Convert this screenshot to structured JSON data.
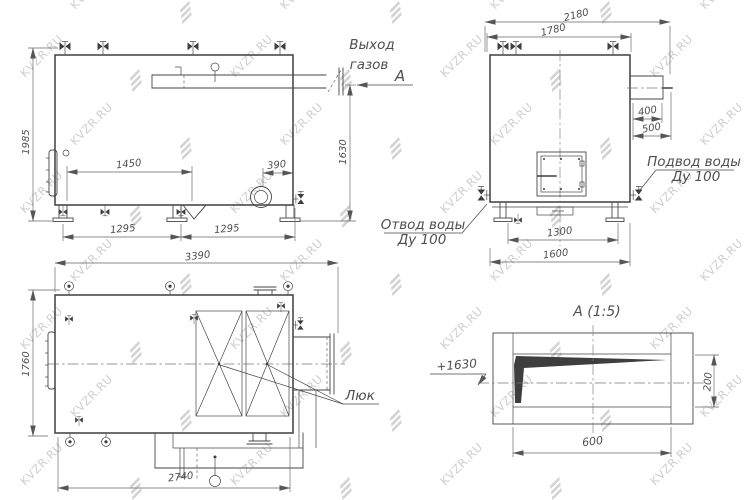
{
  "drawing": {
    "watermark_text": "KVZR.RU",
    "gas_outlet": {
      "line1": "Выход",
      "line2": "газов"
    },
    "section_arrow_label": "А",
    "side_view": {
      "dims": {
        "height": "1985",
        "flue_axis_height": "1630",
        "valve_spacing": "1450",
        "burner_offset": "390",
        "base_left": "1295",
        "base_right": "1295"
      }
    },
    "front_view": {
      "dims": {
        "overall_width": "2180",
        "body_width": "1780",
        "flue_width": "400",
        "flue_overall": "500",
        "feet_span": "1300",
        "base_width": "1600"
      },
      "water_inlet": {
        "line1": "Подвод воды",
        "line2": "Ду 100"
      },
      "water_outlet": {
        "line1": "Отвод воды",
        "line2": "Ду 100"
      }
    },
    "top_view": {
      "dims": {
        "overall_length": "3390",
        "depth": "1760",
        "body_length": "2740"
      },
      "hatch_label": "Люк"
    },
    "detail_view": {
      "title": "А (1:5)",
      "elevation_mark": "+1630",
      "dims": {
        "height": "200",
        "width": "600"
      }
    }
  }
}
